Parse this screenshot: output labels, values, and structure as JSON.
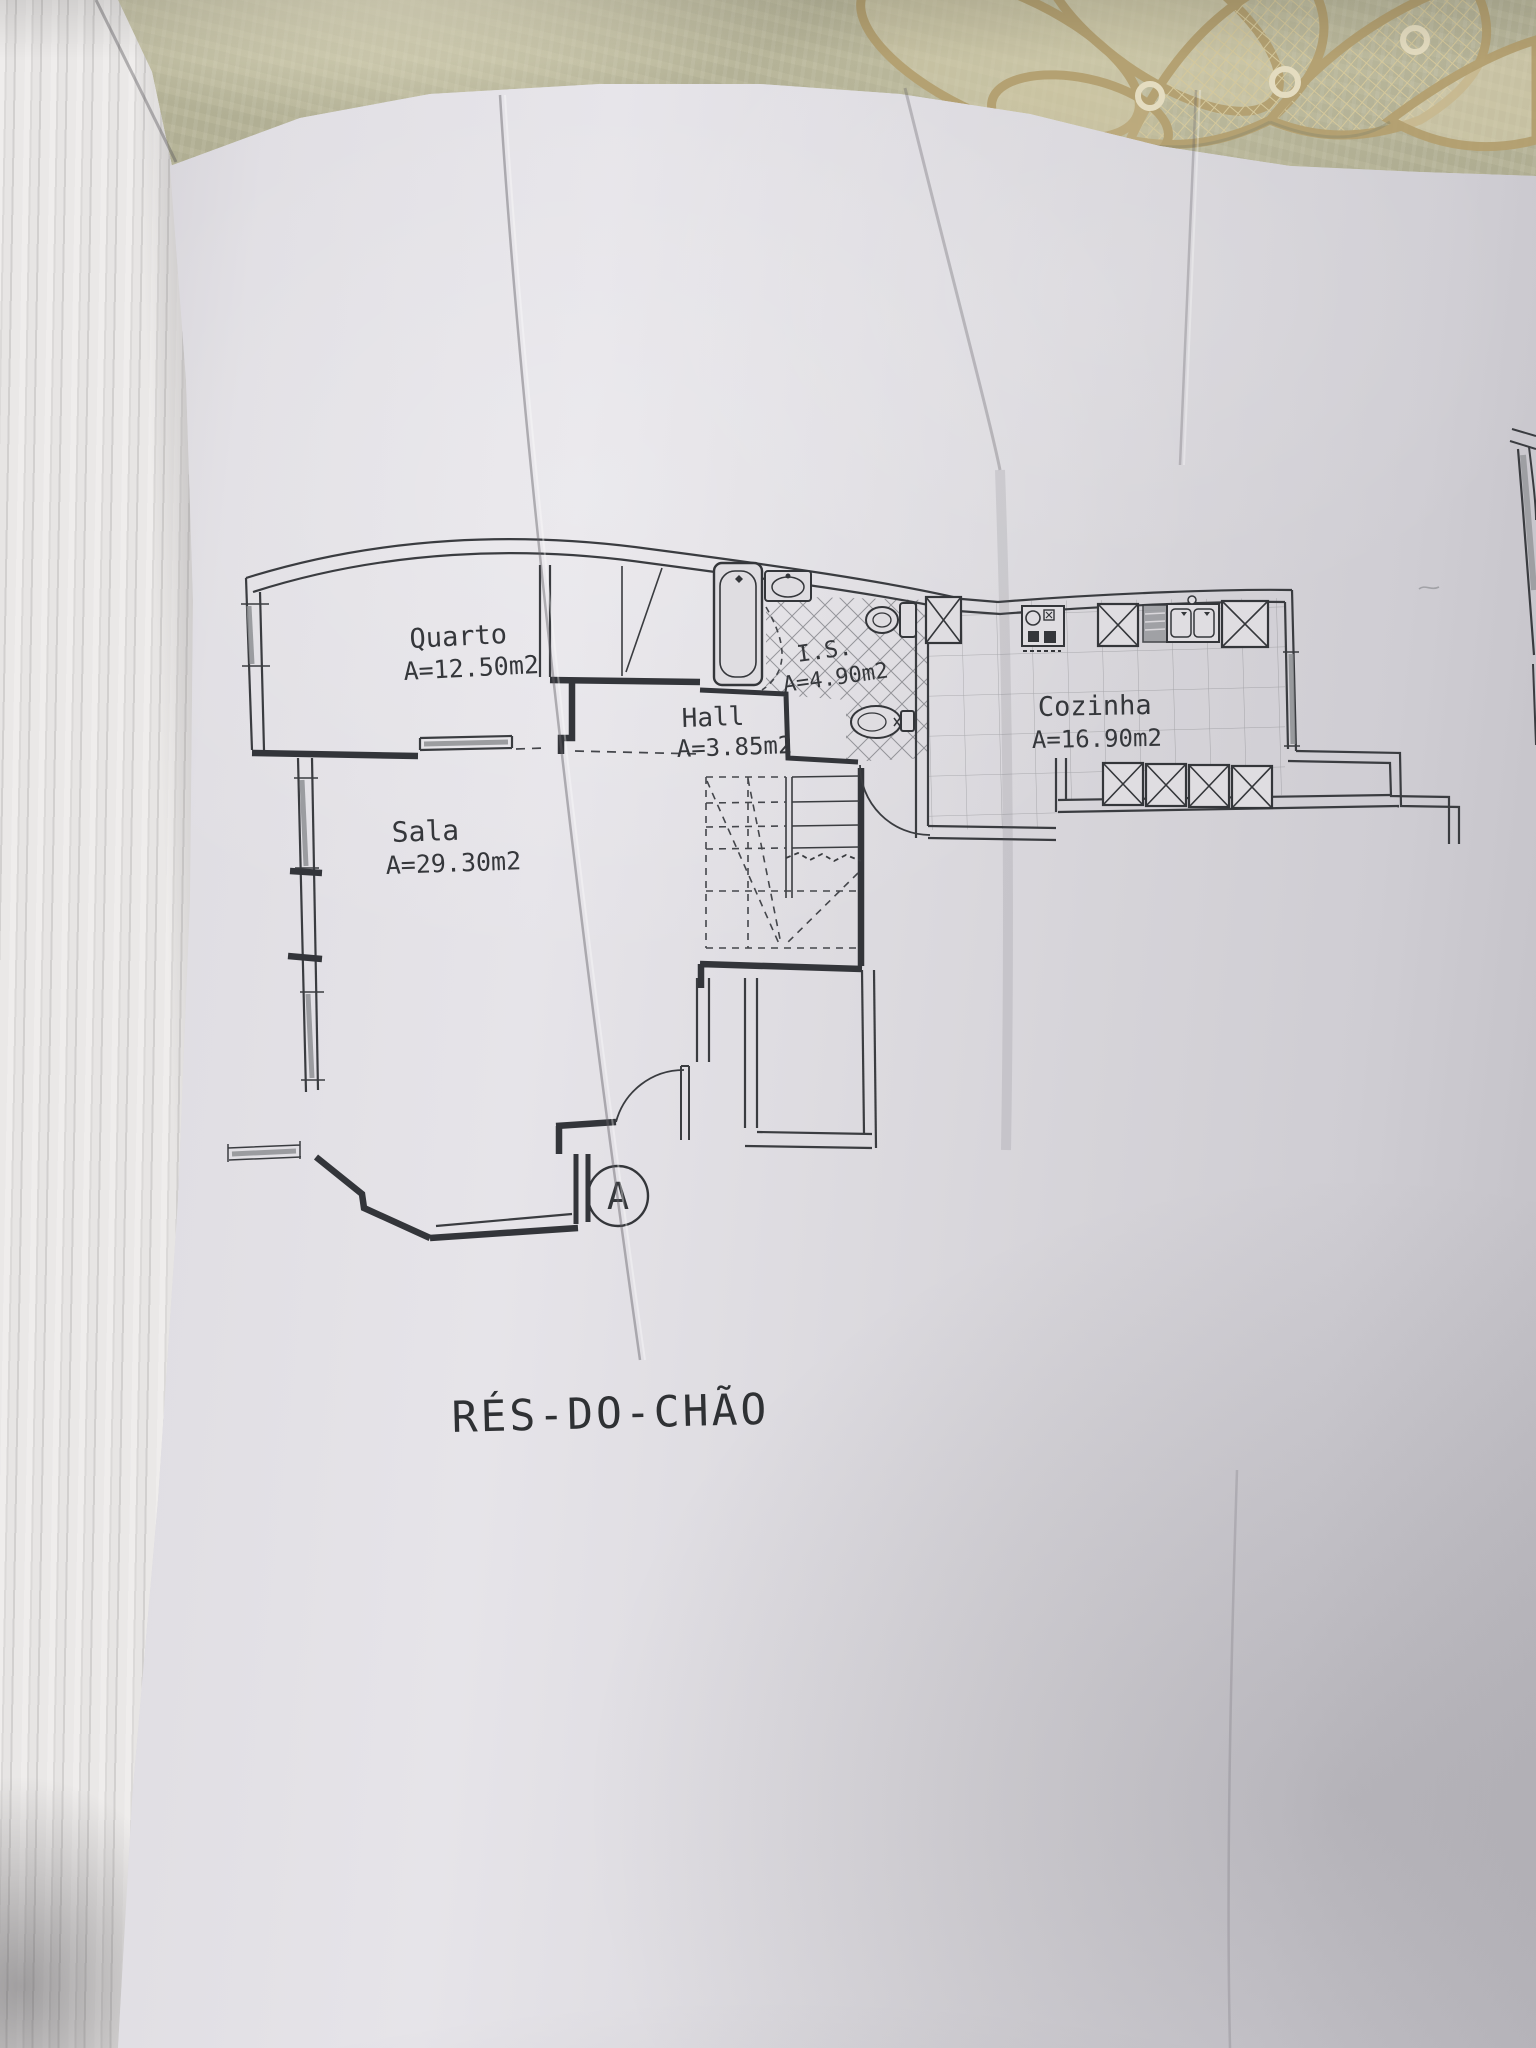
{
  "plan": {
    "title": "RÉS-DO-CHÃO",
    "rooms": [
      {
        "id": "quarto",
        "name": "Quarto",
        "area": "A=12.50m2"
      },
      {
        "id": "sala",
        "name": "Sala",
        "area": "A=29.30m2"
      },
      {
        "id": "hall",
        "name": "Hall",
        "area": "A=3.85m2"
      },
      {
        "id": "is",
        "name": "I.S.",
        "area": "A=4.90m2"
      },
      {
        "id": "cozinha",
        "name": "Cozinha",
        "area": "A=16.90m2"
      }
    ],
    "entrance_marker": "A",
    "fixtures": [
      "bathtub",
      "washbasin",
      "toilet",
      "bidet",
      "closet",
      "staircase",
      "stove",
      "counter",
      "double-sink",
      "cabinet-boxes",
      "windows",
      "entrance-door",
      "shaft"
    ],
    "colors": {
      "ink": "#3a3c40",
      "paper": "#dcdade",
      "tablecloth": "#b5b499",
      "lace": "#c9b88e",
      "pages": "#e8e6e6"
    }
  }
}
